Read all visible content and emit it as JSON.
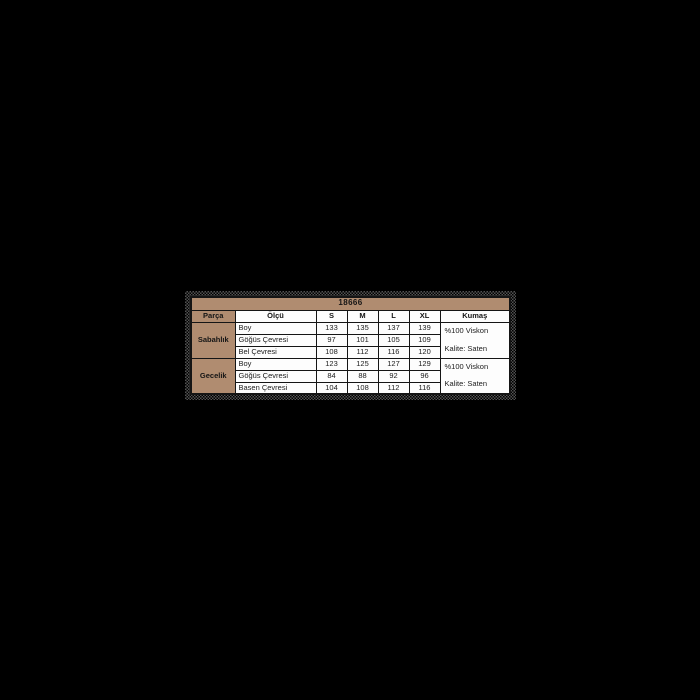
{
  "page": {
    "background_color": "#000000"
  },
  "table": {
    "title": "18666",
    "colors": {
      "header_bg": "#b08c70",
      "cell_bg": "#fdfdfd",
      "border": "#151515",
      "text": "#202020",
      "speckle_halo": "#525252"
    },
    "columns": [
      "Parça",
      "Ölçü",
      "S",
      "M",
      "L",
      "XL",
      "Kumaş"
    ],
    "groups": [
      {
        "name": "Sabahlık",
        "rows": [
          {
            "label": "Boy",
            "values": [
              "133",
              "135",
              "137",
              "139"
            ]
          },
          {
            "label": "Göğüs Çevresi",
            "values": [
              "97",
              "101",
              "105",
              "109"
            ]
          },
          {
            "label": "Bel Çevresi",
            "values": [
              "108",
              "112",
              "116",
              "120"
            ]
          }
        ],
        "fabric": [
          "%100 Viskon",
          "Kalite: Saten"
        ]
      },
      {
        "name": "Gecelik",
        "rows": [
          {
            "label": "Boy",
            "values": [
              "123",
              "125",
              "127",
              "129"
            ]
          },
          {
            "label": "Göğüs Çevresi",
            "values": [
              "84",
              "88",
              "92",
              "96"
            ]
          },
          {
            "label": "Basen Çevresi",
            "values": [
              "104",
              "108",
              "112",
              "116"
            ]
          }
        ],
        "fabric": [
          "%100 Viskon",
          "Kalite: Saten"
        ]
      }
    ]
  }
}
